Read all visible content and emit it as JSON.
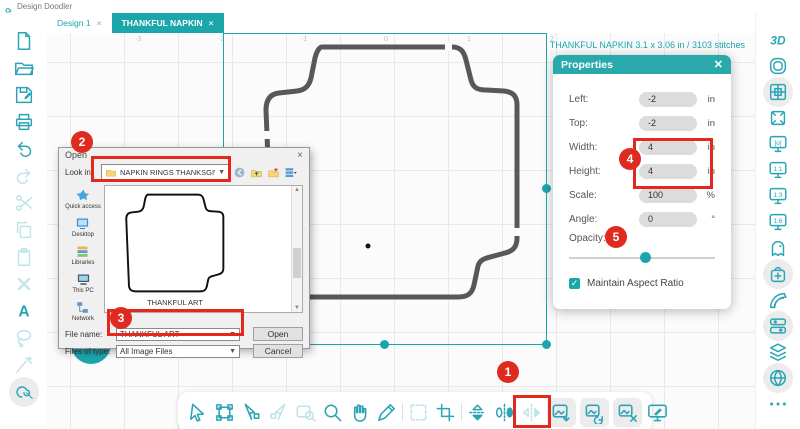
{
  "app": {
    "title": "Design Doodler",
    "brand_color": "#1ba6ac",
    "annotation_color": "#e02a1f",
    "outline_color": "#58585a"
  },
  "tabs": [
    {
      "label": "Design 1",
      "close": "×",
      "active": false
    },
    {
      "label": "THANKFUL NAPKIN",
      "close": "×",
      "active": true
    }
  ],
  "stats_text": "THANKFUL NAPKIN   3.1 x 3.06 in / 3103 stitches",
  "ruler_ticks": [
    "-3",
    "-2",
    "-1",
    "0",
    "1",
    "2"
  ],
  "left_toolbar": [
    {
      "name": "new-design",
      "icon": "doc"
    },
    {
      "name": "open-file",
      "icon": "folder"
    },
    {
      "name": "save",
      "icon": "save"
    },
    {
      "name": "print",
      "icon": "print"
    },
    {
      "name": "undo",
      "icon": "undo"
    },
    {
      "name": "redo",
      "icon": "redo",
      "disabled": true
    },
    {
      "name": "cut",
      "icon": "scissors",
      "disabled": true
    },
    {
      "name": "copy",
      "icon": "copy",
      "disabled": true
    },
    {
      "name": "paste",
      "icon": "paste",
      "disabled": true
    },
    {
      "name": "delete",
      "icon": "xmark",
      "disabled": true
    },
    {
      "name": "text-tool",
      "icon": "textA"
    },
    {
      "name": "lasso-tool",
      "icon": "lasso",
      "disabled": true
    },
    {
      "name": "magic-tool",
      "icon": "magic",
      "disabled": true
    },
    {
      "name": "doodle-tool",
      "icon": "doodle",
      "highlighted": true
    }
  ],
  "right_toolbar": [
    {
      "name": "view-3d",
      "icon": "threed"
    },
    {
      "name": "hoop",
      "icon": "hoop"
    },
    {
      "name": "grid-toggle",
      "icon": "grid",
      "highlighted": true
    },
    {
      "name": "fit-to-screen",
      "icon": "expand"
    },
    {
      "name": "zoom-preview",
      "icon": "monitoro"
    },
    {
      "name": "zoom-1-1",
      "icon": "m11"
    },
    {
      "name": "zoom-1-3",
      "icon": "m13"
    },
    {
      "name": "zoom-1-6",
      "icon": "m16"
    },
    {
      "name": "mascot",
      "icon": "ghost"
    },
    {
      "name": "store",
      "icon": "bag",
      "highlighted": true
    },
    {
      "name": "thread-colors",
      "icon": "palette"
    },
    {
      "name": "stitch-settings",
      "icon": "rows",
      "highlighted": true
    },
    {
      "name": "layers",
      "icon": "layers"
    },
    {
      "name": "stitch-globe",
      "icon": "globe",
      "highlighted": true
    },
    {
      "name": "more-options",
      "icon": "dots"
    }
  ],
  "bottom_toolbar": [
    {
      "name": "select-cursor",
      "icon": "cursor"
    },
    {
      "name": "transform",
      "icon": "transform"
    },
    {
      "name": "node-edit",
      "icon": "node"
    },
    {
      "name": "node-convert",
      "icon": "node2",
      "disabled": true
    },
    {
      "name": "zoom-select",
      "icon": "zoomsel",
      "disabled": true
    },
    {
      "name": "zoom",
      "icon": "magnifier"
    },
    {
      "name": "pan-hand",
      "icon": "hand"
    },
    {
      "name": "measure-pen",
      "icon": "pen"
    },
    {
      "sep": true
    },
    {
      "name": "marquee-select",
      "icon": "marquee",
      "disabled": true
    },
    {
      "name": "crop",
      "icon": "crop"
    },
    {
      "sep": true
    },
    {
      "name": "flip-stack",
      "icon": "flipstack"
    },
    {
      "name": "flip-vertical",
      "icon": "flipv"
    },
    {
      "name": "flip-horizontal",
      "icon": "fliph",
      "disabled": true
    },
    {
      "name": "import-image",
      "icon": "imgimport",
      "chip": true
    },
    {
      "name": "replace-image",
      "icon": "imgrotate",
      "chip": true
    },
    {
      "name": "remove-image",
      "icon": "imgx",
      "chip": true
    },
    {
      "name": "trace-image",
      "icon": "monitordraw"
    }
  ],
  "properties_panel": {
    "title": "Properties",
    "close_glyph": "✕",
    "fields": [
      {
        "label": "Left:",
        "value": "-2",
        "unit": "in"
      },
      {
        "label": "Top:",
        "value": "-2",
        "unit": "in"
      },
      {
        "label": "Width:",
        "value": "4",
        "unit": "in"
      },
      {
        "label": "Height:",
        "value": "4",
        "unit": "in"
      },
      {
        "label": "Scale:",
        "value": "100",
        "unit": "%"
      },
      {
        "label": "Angle:",
        "value": "0",
        "unit": "°"
      }
    ],
    "opacity_label": "Opacity:",
    "opacity_percent": 52,
    "checkbox": {
      "checked": true,
      "check_glyph": "✓",
      "label": "Maintain Aspect Ratio"
    }
  },
  "open_dialog": {
    "title": "Open",
    "close_glyph": "×",
    "look_in_label": "Look in:",
    "folder_value": "NAPKIN RINGS THANKSGIVING",
    "dropdown_glyph": "▼",
    "nav_buttons": [
      {
        "name": "back",
        "icon": "navback"
      },
      {
        "name": "up-one-level",
        "icon": "navup"
      },
      {
        "name": "new-folder",
        "icon": "navnew"
      },
      {
        "name": "view-menu",
        "icon": "navview"
      }
    ],
    "places": [
      {
        "name": "quick-access",
        "label": "Quick access",
        "icon": "star"
      },
      {
        "name": "desktop",
        "label": "Desktop",
        "icon": "desktop"
      },
      {
        "name": "libraries",
        "label": "Libraries",
        "icon": "libraries"
      },
      {
        "name": "this-pc",
        "label": "This PC",
        "icon": "thispc"
      },
      {
        "name": "network",
        "label": "Network",
        "icon": "network"
      }
    ],
    "preview_caption": "THANKFUL ART",
    "scroll_up_glyph": "▲",
    "scroll_down_glyph": "▼",
    "file_name_label": "File name:",
    "file_name_value": "THANKFUL ART",
    "file_type_label": "Files of type:",
    "file_type_value": "All Image Files",
    "open_button": "Open",
    "cancel_button": "Cancel"
  },
  "annotations": {
    "badges": [
      "1",
      "2",
      "3",
      "4",
      "5"
    ]
  }
}
